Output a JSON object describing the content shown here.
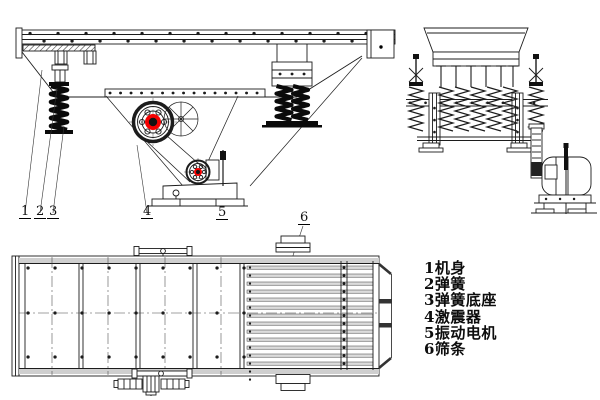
{
  "colors": {
    "accent-red": "#f40000",
    "line": "#1c1c1c"
  },
  "callouts": [
    "1",
    "2",
    "3",
    "4",
    "5",
    "6"
  ],
  "legend": {
    "items": [
      "1机身",
      "2弹簧",
      "3弹簧底座",
      "4激震器",
      "5振动电机",
      "6筛条"
    ]
  }
}
